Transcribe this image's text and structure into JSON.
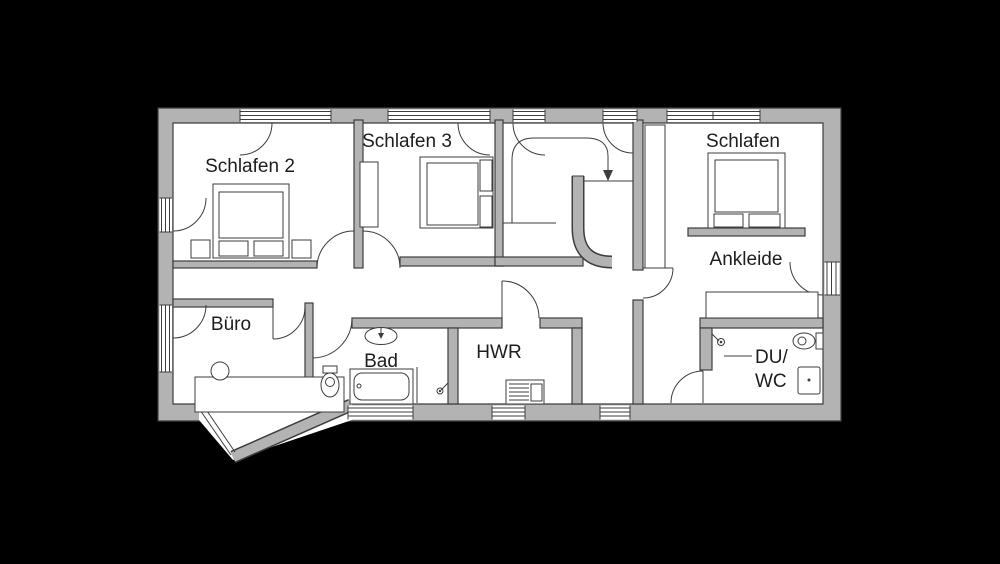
{
  "floor_plan": {
    "colors": {
      "background": "#000000",
      "wall": "#b3b3b3",
      "wall_outline": "#3d3d3d",
      "floor": "#ffffff",
      "label_text": "#1d1d1d"
    },
    "rooms": [
      {
        "id": "schlafen-2",
        "label": "Schlafen 2"
      },
      {
        "id": "schlafen-3",
        "label": "Schlafen 3"
      },
      {
        "id": "schlafen",
        "label": "Schlafen"
      },
      {
        "id": "ankleide",
        "label": "Ankleide"
      },
      {
        "id": "buero",
        "label": "Büro"
      },
      {
        "id": "bad",
        "label": "Bad"
      },
      {
        "id": "hwr",
        "label": "HWR"
      },
      {
        "id": "du-wc",
        "label": "DU/WC",
        "line1": "DU/",
        "line2": "WC"
      }
    ]
  }
}
